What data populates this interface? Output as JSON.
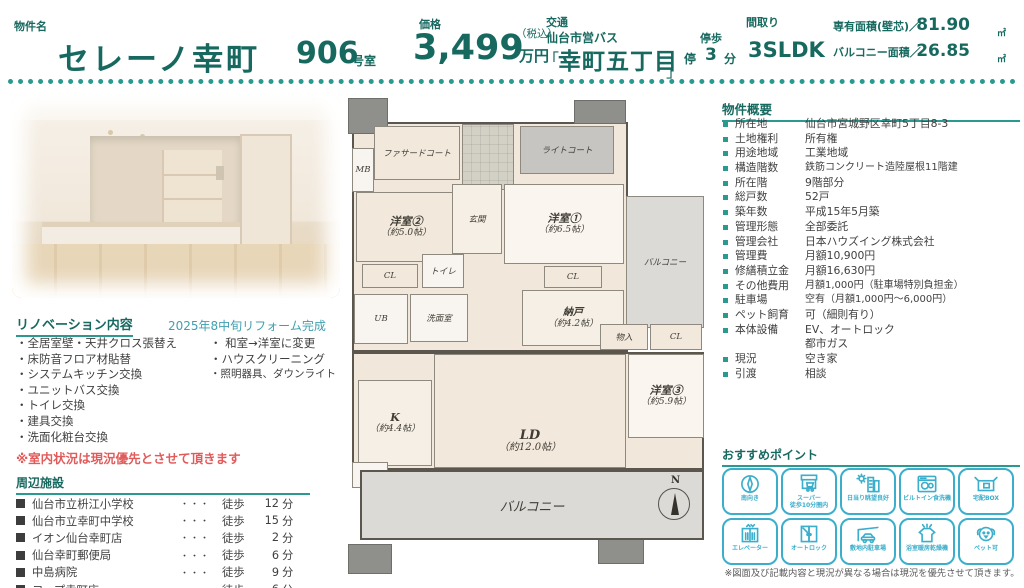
{
  "header": {
    "property_label": "物件名",
    "property_name": "セレーノ幸町",
    "room_number": "906",
    "room_suffix": "号室",
    "price_label": "価格",
    "price_value": "3,499",
    "price_tax": "（税込）",
    "price_unit": "万円",
    "transit_label": "交通",
    "transit_line": "仙台市営バス",
    "bracket_open": "「",
    "stop_name": "幸町五丁目",
    "bracket_close": "」",
    "walk_label": "停歩",
    "walk_stop": "停",
    "walk_min": "3",
    "walk_unit": "分",
    "layout_label": "間取り",
    "layout_value": "3SLDK",
    "area_label": "専有面積(壁芯)／",
    "area_value": "81.90",
    "area_unit": "㎡",
    "balcony_label": "バルコニー面積／",
    "balcony_value": "26.85",
    "balcony_unit": "㎡"
  },
  "renovation": {
    "title": "リノベーション内容",
    "date_note": "2025年8中旬リフォーム完成",
    "items_left": [
      "・全居室壁・天井クロス張替え",
      "・床防音フロア材貼替",
      "・システムキッチン交換",
      "・ユニットバス交換",
      "・トイレ交換",
      "・建具交換",
      "・洗面化粧台交換"
    ],
    "items_right": [
      "・ 和室→洋室に変更",
      "・ハウスクリーニング",
      "・照明器具、ダウンライト"
    ],
    "warning": "※室内状況は現況優先とさせて頂きます"
  },
  "facilities": {
    "title": "周辺施設",
    "dots": "・・・",
    "walk": "徒歩",
    "unit": "分",
    "rows": [
      {
        "name": "仙台市立枡江小学校",
        "min": "12"
      },
      {
        "name": "仙台市立幸町中学校",
        "min": "15"
      },
      {
        "name": "イオン仙台幸町店",
        "min": "2"
      },
      {
        "name": "仙台幸町郵便局",
        "min": "6"
      },
      {
        "name": "中島病院",
        "min": "9"
      },
      {
        "name": "コープ幸町店",
        "min": "6"
      }
    ]
  },
  "overview": {
    "title": "物件概要",
    "rows": [
      {
        "label": "所在地",
        "value": "仙台市宮城野区幸町5丁目8-3"
      },
      {
        "label": "土地権利",
        "value": "所有権"
      },
      {
        "label": "用途地域",
        "value": "工業地域"
      },
      {
        "label": "構造階数",
        "value": "鉄筋コンクリート造陸屋根11階建"
      },
      {
        "label": "所在階",
        "value": "9階部分"
      },
      {
        "label": "総戸数",
        "value": "52戸"
      },
      {
        "label": "築年数",
        "value": "平成15年5月築"
      },
      {
        "label": "管理形態",
        "value": "全部委託"
      },
      {
        "label": "管理会社",
        "value": "日本ハウズイング株式会社"
      },
      {
        "label": "管理費",
        "value": "月額10,900円"
      },
      {
        "label": "修繕積立金",
        "value": "月額16,630円"
      },
      {
        "label": "その他費用",
        "value": "月額1,000円（駐車場特別負担金）"
      },
      {
        "label": "駐車場",
        "value": "空有（月額1,000円～6,000円）"
      },
      {
        "label": "ペット飼育",
        "value": "可（細則有り）"
      },
      {
        "label": "本体設備",
        "value": "EV、オートロック",
        "value2": "都市ガス"
      },
      {
        "label": "現況",
        "value": "空き家"
      },
      {
        "label": "引渡",
        "value": "相談"
      }
    ]
  },
  "points": {
    "title": "おすすめポイント",
    "items": [
      {
        "icon": "compass-icon",
        "label": "南向き"
      },
      {
        "icon": "supermarket-icon",
        "label": "スーパー",
        "label2": "徒歩10分圏内"
      },
      {
        "icon": "sunny-view-icon",
        "label": "日当り眺望良好"
      },
      {
        "icon": "dishwasher-icon",
        "label": "ビルトイン食洗機"
      },
      {
        "icon": "delivery-box-icon",
        "label": "宅配BOX"
      },
      {
        "icon": "elevator-icon",
        "label": "エレベーター"
      },
      {
        "icon": "autolock-icon",
        "label": "オートロック"
      },
      {
        "icon": "parking-icon",
        "label": "敷地内駐車場"
      },
      {
        "icon": "bath-dryer-icon",
        "label": "浴室暖房乾燥機"
      },
      {
        "icon": "pet-icon",
        "label": "ペット可"
      }
    ]
  },
  "disclaimer": "※図面及び記載内容と現況が異なる場合は現況を優先させて頂きます。",
  "floorplan": {
    "facade_court": "ファサードコート",
    "mb": "MB",
    "genkan": "玄関",
    "light_court": "ライトコート",
    "room2_name": "洋室②",
    "room2_size": "（約5.0帖）",
    "room1_name": "洋室①",
    "room1_size": "（約6.5帖）",
    "balcony_right": "バルコニー",
    "cl1": "CL",
    "toilet": "トイレ",
    "senmen": "洗面室",
    "ub": "UB",
    "cl2": "CL",
    "nando_name": "納戸",
    "nando_size": "（約4.2帖）",
    "monoire": "物入",
    "cl3": "CL",
    "k_name": "K",
    "k_size": "（約4.4帖）",
    "ld_name": "LD",
    "ld_size": "（約12.0帖）",
    "room3_name": "洋室③",
    "room3_size": "（約5.9帖）",
    "tr": "TR",
    "balcony_bottom": "バルコニー",
    "compass_n": "N"
  },
  "colors": {
    "accent_teal": "#176960",
    "underline_teal": "#2a9a90",
    "icon_cyan": "#3aaecb",
    "warning_red": "#e25b5b",
    "note_teal": "#3f9fae"
  }
}
